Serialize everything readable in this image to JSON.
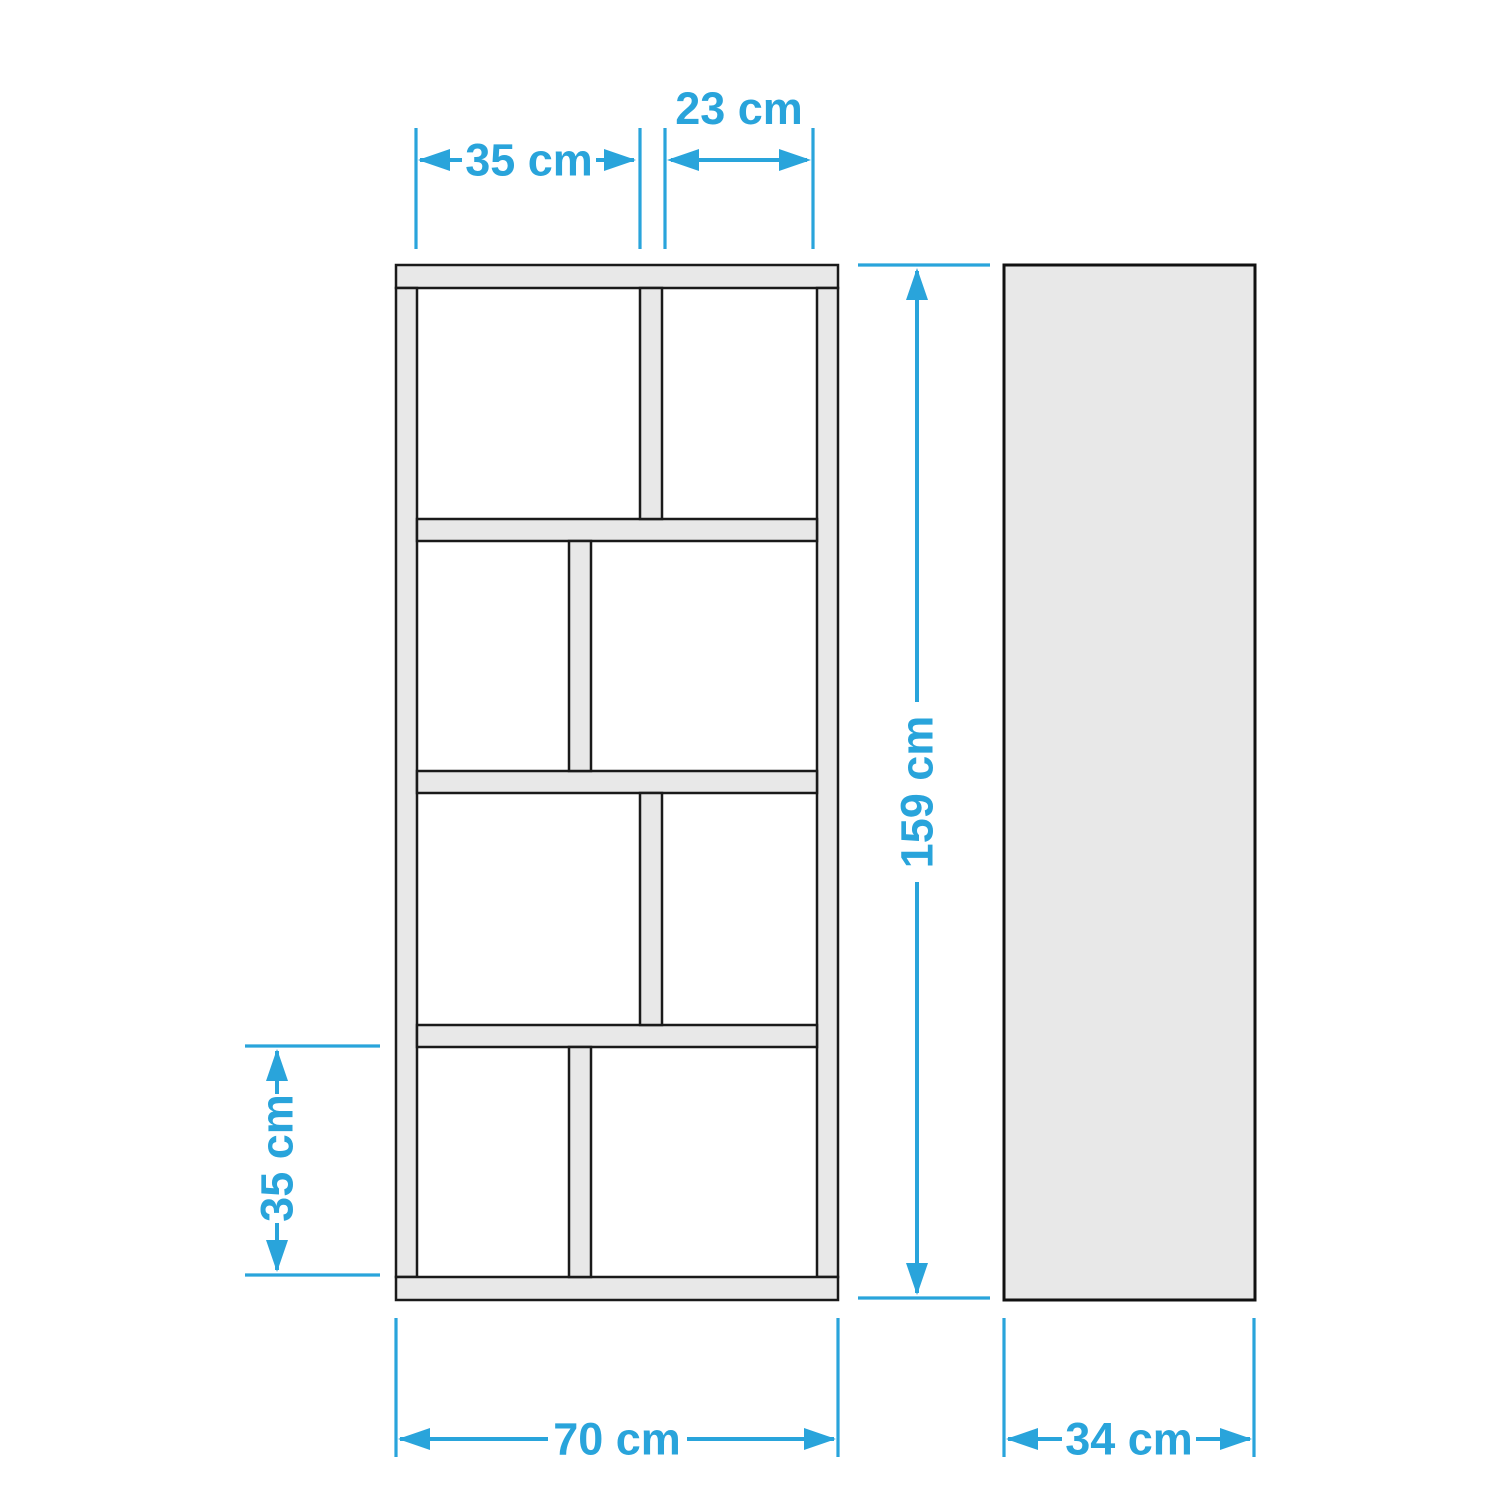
{
  "dimensions": {
    "dim_top_left": "35 cm",
    "dim_top_right": "23 cm",
    "dim_height": "159 cm",
    "dim_bottom_left": "35 cm",
    "dim_total_width": "70 cm",
    "dim_depth": "34 cm"
  },
  "colors": {
    "dimension_annotation": "#29a4db",
    "panel_fill": "#e8e8e8",
    "panel_outline": "#1a1a1a",
    "background": "#ffffff"
  }
}
